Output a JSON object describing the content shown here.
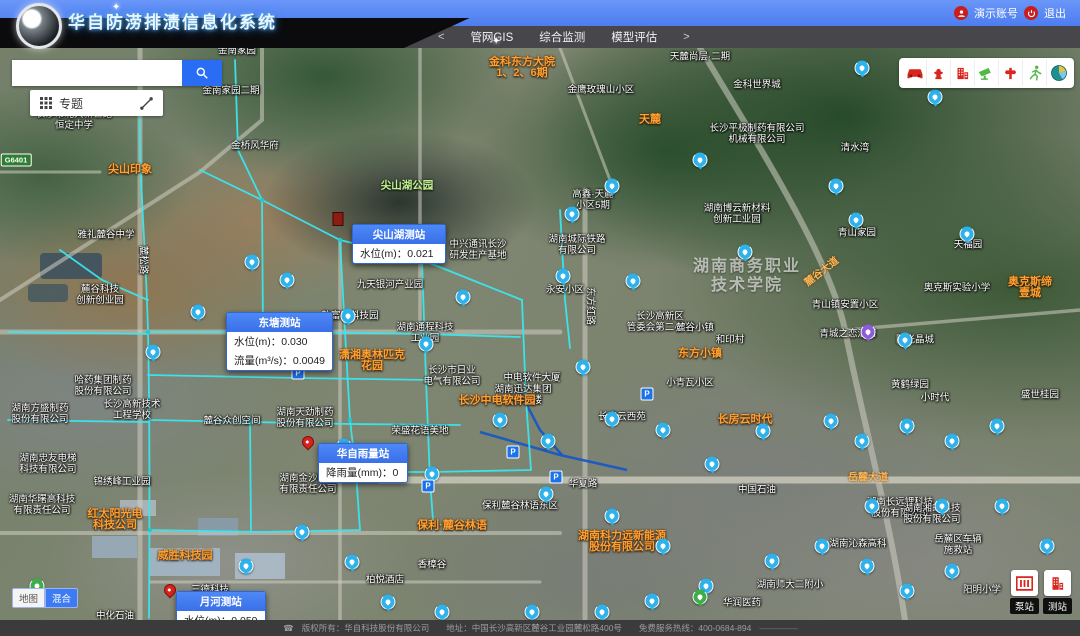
{
  "header": {
    "title": "华自防涝排渍信息化系统",
    "nav_prev": "<",
    "nav_next": ">",
    "nav": [
      "管网GIS",
      "综合监测",
      "模型评估"
    ],
    "account": "演示账号",
    "logout": "退出"
  },
  "search": {
    "value": "",
    "placeholder": ""
  },
  "topic_bar": {
    "label": "专题"
  },
  "toolbar": {
    "icons": [
      "car-icon",
      "hydrant-icon",
      "building-icon",
      "camera-icon",
      "valve-icon",
      "runner-icon",
      "stats-globe-icon"
    ]
  },
  "basemap_toggle": {
    "map": "地图",
    "hybrid": "混合"
  },
  "corner_buttons": [
    {
      "label": "泵站"
    },
    {
      "label": "测站"
    }
  ],
  "road_shield": {
    "text": "G6401",
    "x": 16,
    "y": 112
  },
  "footer": {
    "text": "版权所有：华自科技股份有限公司　　地址：中国长沙高新区麓谷工业园麓松路400号　　免费服务热线：400-0684-894",
    "phone_icon": "☎",
    "dash": "—————"
  },
  "colors": {
    "accent_blue": "#3d7bf5",
    "pipe_cyan": "#3ae6ef",
    "poi_orange": "#ffa033",
    "alert_red": "#c81e1e",
    "tool_red": "#d9251d",
    "tool_green": "#53b848"
  },
  "map": {
    "popups": [
      {
        "title": "尖山湖测站",
        "x": 352,
        "y": 176,
        "w": 92,
        "rows": [
          {
            "k": "水位(m)",
            "v": "0.021"
          }
        ]
      },
      {
        "title": "东塘测站",
        "x": 226,
        "y": 264,
        "w": 90,
        "rows": [
          {
            "k": "水位(m)",
            "v": "0.030"
          },
          {
            "k": "流量(m³/s)",
            "v": "0.0049"
          }
        ]
      },
      {
        "title": "华自雨量站",
        "x": 318,
        "y": 395,
        "w": 88,
        "rows": [
          {
            "k": "降雨量(mm)",
            "v": "0"
          }
        ]
      },
      {
        "title": "月河测站",
        "x": 176,
        "y": 543,
        "w": 86,
        "rows": [
          {
            "k": "水位(m)",
            "v": "0.059"
          }
        ]
      }
    ],
    "pins": [
      {
        "x": 338,
        "y": 178,
        "type": "flag"
      },
      {
        "x": 308,
        "y": 400,
        "type": "pin"
      },
      {
        "x": 170,
        "y": 548,
        "type": "pin"
      }
    ],
    "labels": [
      {
        "t": "金南家园",
        "x": 237,
        "y": 3,
        "c": "w"
      },
      {
        "t": "金南家园二期",
        "x": 231,
        "y": 43,
        "c": "w"
      },
      {
        "t": "金科东方大院\n1、2、6期",
        "x": 522,
        "y": 20,
        "c": "o"
      },
      {
        "t": "天麓尚层·二期",
        "x": 700,
        "y": 9,
        "c": "w"
      },
      {
        "t": "金鹰玫瑰山小区",
        "x": 601,
        "y": 42,
        "c": "w"
      },
      {
        "t": "金科世界城",
        "x": 757,
        "y": 37,
        "c": "w"
      },
      {
        "t": "长沙市北大新世纪\n恒定中学",
        "x": 74,
        "y": 72,
        "c": "w"
      },
      {
        "t": "金桥风华府",
        "x": 255,
        "y": 98,
        "c": "w"
      },
      {
        "t": "天麓",
        "x": 650,
        "y": 72,
        "c": "o"
      },
      {
        "t": "长沙平极制药有限公司\n机械有限公司",
        "x": 757,
        "y": 86,
        "c": "w"
      },
      {
        "t": "清水湾",
        "x": 855,
        "y": 100,
        "c": "w"
      },
      {
        "t": "尖山印象",
        "x": 130,
        "y": 122,
        "c": "o"
      },
      {
        "t": "尖山湖公园",
        "x": 407,
        "y": 138,
        "c": "g"
      },
      {
        "t": "高鑫·天麓\n小区5期",
        "x": 593,
        "y": 152,
        "c": "w"
      },
      {
        "t": "雅礼麓谷中学",
        "x": 106,
        "y": 187,
        "c": "w"
      },
      {
        "t": "湖南博云新材料\n创新工业园",
        "x": 737,
        "y": 166,
        "c": "w"
      },
      {
        "t": "青山家园",
        "x": 857,
        "y": 185,
        "c": "w"
      },
      {
        "t": "天福园",
        "x": 968,
        "y": 197,
        "c": "w"
      },
      {
        "t": "中兴通讯长沙\n研发生产基地",
        "x": 478,
        "y": 202,
        "c": "w"
      },
      {
        "t": "湖南城际铁路\n有限公司",
        "x": 577,
        "y": 197,
        "c": "w"
      },
      {
        "t": "湖南商务职业\n技术学院",
        "x": 747,
        "y": 228,
        "c": "lg"
      },
      {
        "t": "奥克斯实验小学",
        "x": 957,
        "y": 240,
        "c": "w"
      },
      {
        "t": "奥克斯缔壹城",
        "x": 1030,
        "y": 240,
        "c": "o"
      },
      {
        "t": "麓谷科技\n创新创业园",
        "x": 100,
        "y": 247,
        "c": "w"
      },
      {
        "t": "九天银河产业园",
        "x": 390,
        "y": 237,
        "c": "w"
      },
      {
        "t": "永安小区",
        "x": 565,
        "y": 242,
        "c": "w"
      },
      {
        "t": "青山镇安置小区",
        "x": 845,
        "y": 257,
        "c": "w"
      },
      {
        "t": "青城之恋酒店",
        "x": 848,
        "y": 286,
        "c": "w"
      },
      {
        "t": "阳光晶城",
        "x": 915,
        "y": 292,
        "c": "w"
      },
      {
        "t": "软富安科技园",
        "x": 350,
        "y": 268,
        "c": "w"
      },
      {
        "t": "湖南通程科技\n工业园",
        "x": 425,
        "y": 285,
        "c": "w"
      },
      {
        "t": "长沙高新区\n管委会第二小学",
        "x": 660,
        "y": 274,
        "c": "w"
      },
      {
        "t": "和印村",
        "x": 730,
        "y": 292,
        "c": "w"
      },
      {
        "t": "麓谷小镇",
        "x": 695,
        "y": 280,
        "c": "w"
      },
      {
        "t": "东方小镇",
        "x": 700,
        "y": 306,
        "c": "o"
      },
      {
        "t": "潇湘奥林匹克\n花园",
        "x": 372,
        "y": 313,
        "c": "o"
      },
      {
        "t": "长沙市日业\n电气有限公司",
        "x": 452,
        "y": 328,
        "c": "w"
      },
      {
        "t": "中电软件大厦",
        "x": 532,
        "y": 330,
        "c": "w"
      },
      {
        "t": "湖南迅达集团\n总部大楼",
        "x": 523,
        "y": 347,
        "c": "w"
      },
      {
        "t": "长沙中电软件园",
        "x": 497,
        "y": 353,
        "c": "o"
      },
      {
        "t": "小青瓦小区",
        "x": 690,
        "y": 335,
        "c": "w"
      },
      {
        "t": "黄鹤绿园",
        "x": 910,
        "y": 337,
        "c": "w"
      },
      {
        "t": "小时代",
        "x": 935,
        "y": 350,
        "c": "w"
      },
      {
        "t": "盛世桂园",
        "x": 1040,
        "y": 347,
        "c": "w"
      },
      {
        "t": "长房云西苑",
        "x": 622,
        "y": 369,
        "c": "w"
      },
      {
        "t": "长房云时代",
        "x": 745,
        "y": 372,
        "c": "o"
      },
      {
        "t": "哈药集团制药\n股份有限公司",
        "x": 103,
        "y": 338,
        "c": "w"
      },
      {
        "t": "湖南方盛制药\n股份有限公司",
        "x": 40,
        "y": 366,
        "c": "w"
      },
      {
        "t": "长沙高新技术\n工程学校",
        "x": 132,
        "y": 362,
        "c": "w"
      },
      {
        "t": "湖南天劲制药\n股份有限公司",
        "x": 305,
        "y": 370,
        "c": "w"
      },
      {
        "t": "麓谷众创空间",
        "x": 232,
        "y": 373,
        "c": "w"
      },
      {
        "t": "荣盛花语美地",
        "x": 420,
        "y": 383,
        "c": "w"
      },
      {
        "t": "湖南忠友电梯\n科技有限公司",
        "x": 48,
        "y": 416,
        "c": "w"
      },
      {
        "t": "锦绣峰工业园",
        "x": 122,
        "y": 434,
        "c": "w"
      },
      {
        "t": "湖南金沙药业\n有限责任公司",
        "x": 308,
        "y": 436,
        "c": "w"
      },
      {
        "t": "湖南华曙高科技\n有限责任公司",
        "x": 42,
        "y": 457,
        "c": "w"
      },
      {
        "t": "保利麓谷林语东区",
        "x": 520,
        "y": 458,
        "c": "w"
      },
      {
        "t": "保利·麓谷林语",
        "x": 452,
        "y": 478,
        "c": "o"
      },
      {
        "t": "红太阳光电\n科技公司",
        "x": 115,
        "y": 472,
        "c": "o"
      },
      {
        "t": "威胜科技园",
        "x": 185,
        "y": 508,
        "c": "o"
      },
      {
        "t": "湖南科力远新能源\n股份有限公司",
        "x": 622,
        "y": 494,
        "c": "o"
      },
      {
        "t": "湖南长远锂科技\n股份有限公司",
        "x": 900,
        "y": 460,
        "c": "w"
      },
      {
        "t": "湖南湘邮科技\n股份有限公司",
        "x": 932,
        "y": 466,
        "c": "w"
      },
      {
        "t": "湖南沁森高科",
        "x": 858,
        "y": 496,
        "c": "w"
      },
      {
        "t": "岳麓区车辆\n施救站",
        "x": 958,
        "y": 497,
        "c": "w"
      },
      {
        "t": "三德科技",
        "x": 210,
        "y": 542,
        "c": "w"
      },
      {
        "t": "香樟谷",
        "x": 432,
        "y": 517,
        "c": "w"
      },
      {
        "t": "柏悦酒店",
        "x": 385,
        "y": 532,
        "c": "w"
      },
      {
        "t": "中化石油",
        "x": 115,
        "y": 568,
        "c": "w"
      },
      {
        "t": "湖南师大二附小",
        "x": 790,
        "y": 537,
        "c": "w"
      },
      {
        "t": "华润医药",
        "x": 742,
        "y": 555,
        "c": "w"
      },
      {
        "t": "阳明小学",
        "x": 982,
        "y": 542,
        "c": "w"
      },
      {
        "t": "中国石油",
        "x": 757,
        "y": 442,
        "c": "w"
      },
      {
        "t": "华夏路",
        "x": 583,
        "y": 436,
        "c": "w"
      },
      {
        "t": "岳麓大道",
        "x": 868,
        "y": 430,
        "c": "road"
      },
      {
        "t": "麓谷大道",
        "x": 822,
        "y": 224,
        "c": "road",
        "rot": -38
      },
      {
        "t": "麓松路",
        "x": 143,
        "y": 212,
        "c": "w",
        "rot": 90
      },
      {
        "t": "东方红路",
        "x": 590,
        "y": 258,
        "c": "w",
        "rot": 90
      }
    ],
    "stations": [
      {
        "x": 862,
        "y": 20
      },
      {
        "x": 935,
        "y": 49
      },
      {
        "x": 700,
        "y": 112
      },
      {
        "x": 612,
        "y": 138
      },
      {
        "x": 836,
        "y": 138
      },
      {
        "x": 572,
        "y": 166
      },
      {
        "x": 745,
        "y": 204
      },
      {
        "x": 633,
        "y": 233
      },
      {
        "x": 856,
        "y": 172
      },
      {
        "x": 967,
        "y": 186
      },
      {
        "x": 463,
        "y": 249
      },
      {
        "x": 563,
        "y": 228
      },
      {
        "x": 426,
        "y": 296
      },
      {
        "x": 583,
        "y": 319
      },
      {
        "x": 500,
        "y": 372
      },
      {
        "x": 548,
        "y": 393
      },
      {
        "x": 612,
        "y": 371
      },
      {
        "x": 663,
        "y": 382
      },
      {
        "x": 712,
        "y": 416
      },
      {
        "x": 763,
        "y": 383
      },
      {
        "x": 831,
        "y": 373
      },
      {
        "x": 862,
        "y": 393
      },
      {
        "x": 907,
        "y": 378
      },
      {
        "x": 952,
        "y": 393
      },
      {
        "x": 997,
        "y": 378
      },
      {
        "x": 344,
        "y": 398
      },
      {
        "x": 432,
        "y": 426
      },
      {
        "x": 546,
        "y": 446
      },
      {
        "x": 612,
        "y": 468
      },
      {
        "x": 663,
        "y": 498
      },
      {
        "x": 706,
        "y": 538
      },
      {
        "x": 772,
        "y": 513
      },
      {
        "x": 822,
        "y": 498
      },
      {
        "x": 867,
        "y": 518
      },
      {
        "x": 907,
        "y": 543
      },
      {
        "x": 952,
        "y": 523
      },
      {
        "x": 872,
        "y": 458
      },
      {
        "x": 942,
        "y": 458
      },
      {
        "x": 1002,
        "y": 458
      },
      {
        "x": 1047,
        "y": 498
      },
      {
        "x": 252,
        "y": 214
      },
      {
        "x": 198,
        "y": 264
      },
      {
        "x": 153,
        "y": 304
      },
      {
        "x": 302,
        "y": 484
      },
      {
        "x": 352,
        "y": 514
      },
      {
        "x": 388,
        "y": 554
      },
      {
        "x": 246,
        "y": 518
      },
      {
        "x": 442,
        "y": 564
      },
      {
        "x": 532,
        "y": 564
      },
      {
        "x": 602,
        "y": 564
      },
      {
        "x": 652,
        "y": 553
      },
      {
        "x": 905,
        "y": 292
      },
      {
        "x": 348,
        "y": 268
      },
      {
        "x": 287,
        "y": 232
      }
    ],
    "special_markers": [
      {
        "x": 868,
        "y": 284,
        "color": "#8e5bd8"
      },
      {
        "x": 37,
        "y": 538,
        "color": "#3dae4a"
      },
      {
        "x": 700,
        "y": 549,
        "color": "#3dae4a"
      }
    ],
    "parkings": [
      {
        "x": 298,
        "y": 325
      },
      {
        "x": 513,
        "y": 404
      },
      {
        "x": 428,
        "y": 438
      },
      {
        "x": 556,
        "y": 429
      },
      {
        "x": 647,
        "y": 346
      }
    ]
  }
}
